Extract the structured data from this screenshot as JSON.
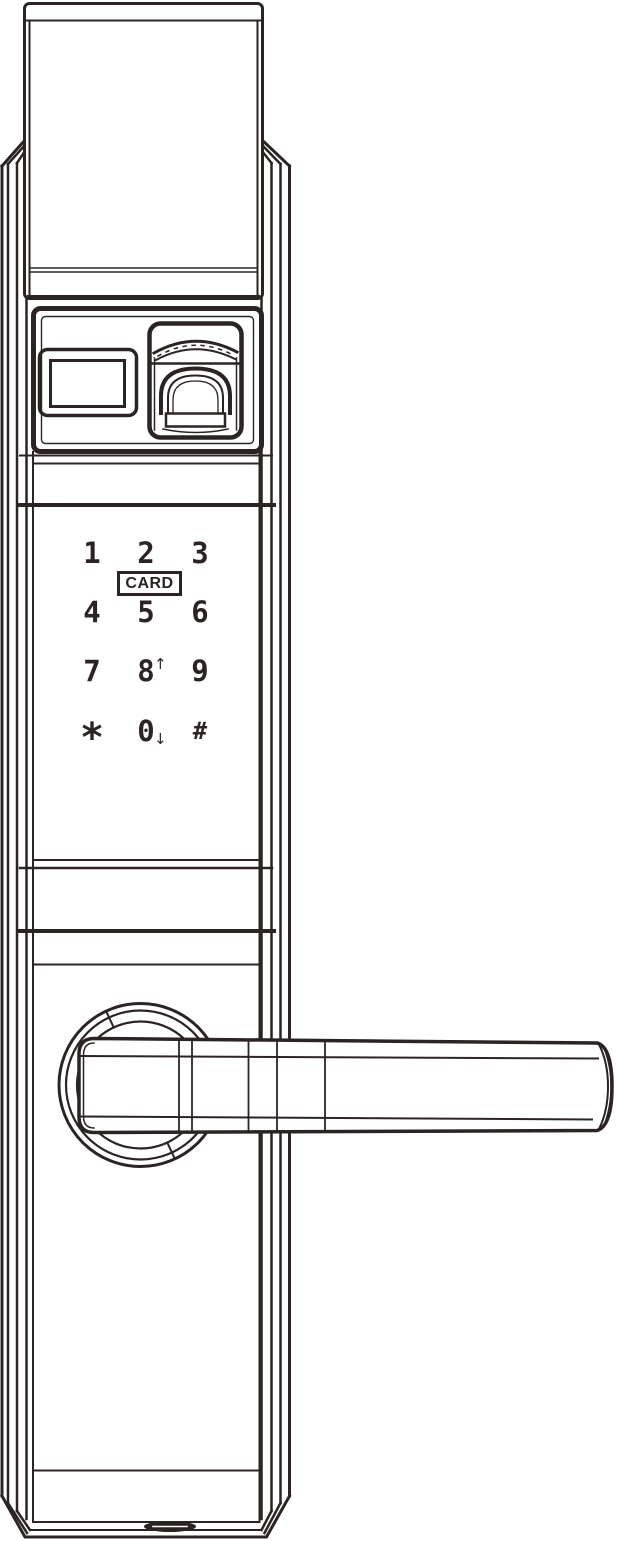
{
  "device": {
    "description_visible_text_only": true
  },
  "colors": {
    "line": "#2b2422",
    "background": "#ffffff"
  },
  "keypad": {
    "keys": [
      {
        "label": "1"
      },
      {
        "label": "2"
      },
      {
        "label": "3"
      },
      {
        "label": "4"
      },
      {
        "label": "5"
      },
      {
        "label": "6"
      },
      {
        "label": "7"
      },
      {
        "label": "8",
        "arrow": "↑"
      },
      {
        "label": "9"
      },
      {
        "label": "*"
      },
      {
        "label": "0",
        "arrow": "↓"
      },
      {
        "label": "#"
      }
    ],
    "card_label": "CARD"
  }
}
